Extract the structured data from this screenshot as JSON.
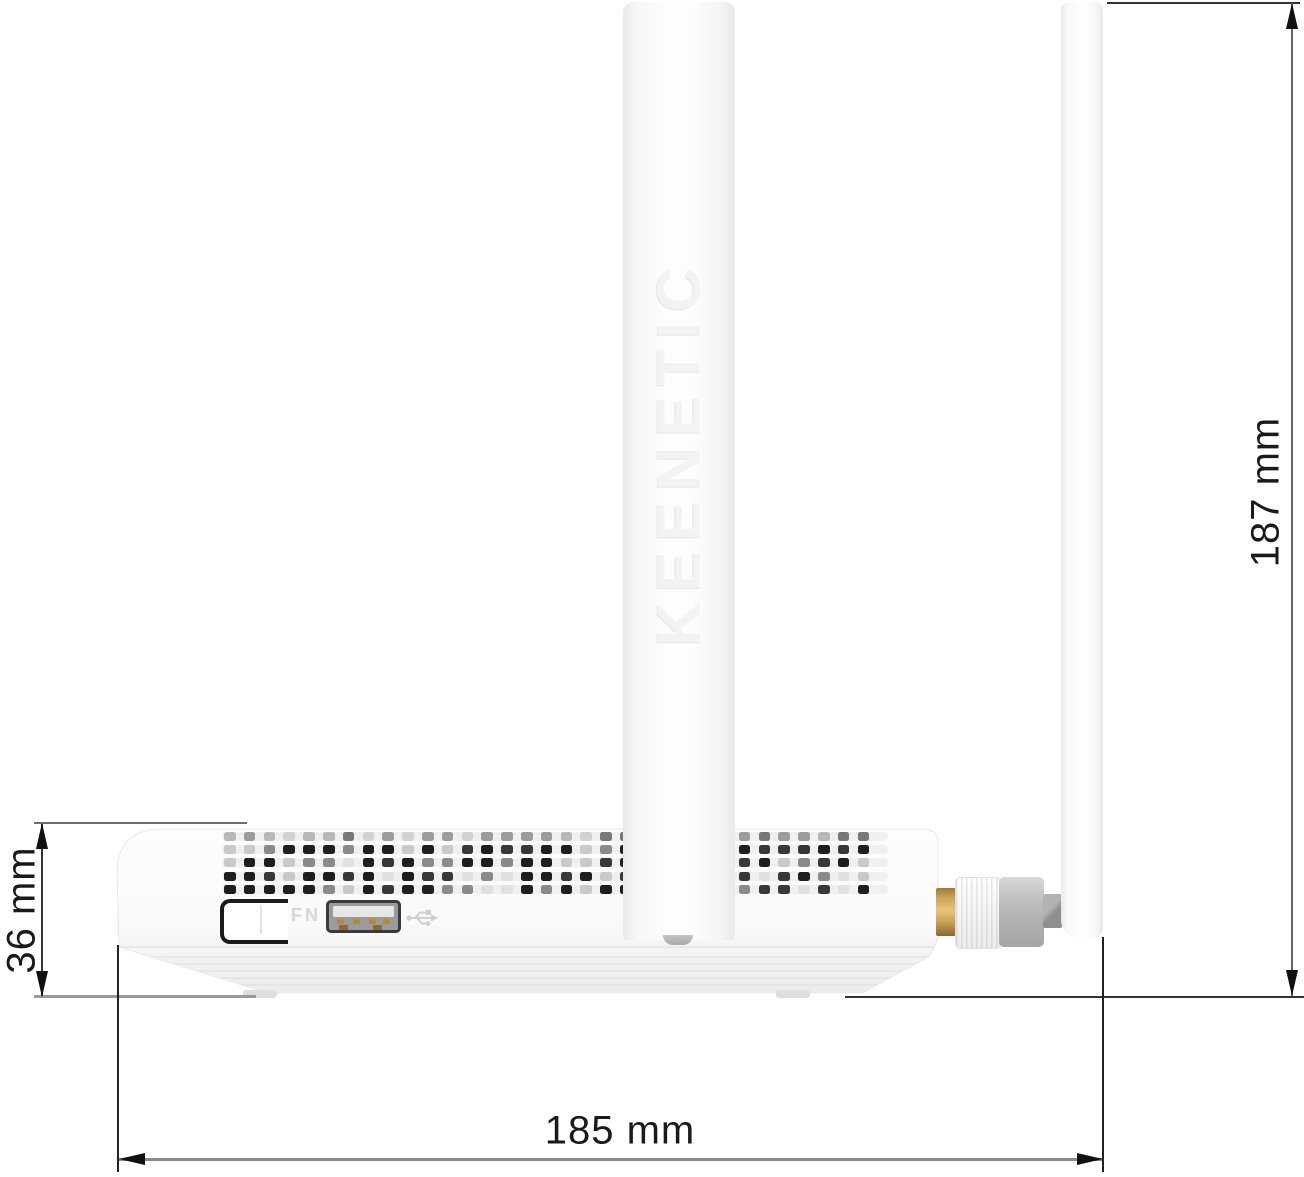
{
  "title": "Keenetic router side view dimensional drawing",
  "device": {
    "brand_embossed": "KEENETIC",
    "fn_button_label": "FN"
  },
  "dimensions": {
    "body_height_label": "36 mm",
    "total_height_label": "187 mm",
    "depth_label": "185 mm"
  },
  "icons": {
    "usb_icon": "usb-trident-icon"
  },
  "colors": {
    "background": "#ffffff",
    "dimension_text": "#1a1a1a",
    "dimension_line_gray": "#8a8a8a",
    "dimension_line_dark": "#333333",
    "gold_connector": "#caa258",
    "connector_gray": "#b5b5b5",
    "body_white": "#fbfbfb"
  },
  "vents": {
    "rows": 5,
    "palette_top": [
      "#9c9c9c",
      "#b8b8b8",
      "#787878",
      "#d2d2d2"
    ],
    "palette_main": [
      "#1e1e1e",
      "#383838",
      "#8a8a8a",
      "#c9c9c9",
      "#e0e0e0"
    ],
    "track_color": "#f0f0f0"
  }
}
